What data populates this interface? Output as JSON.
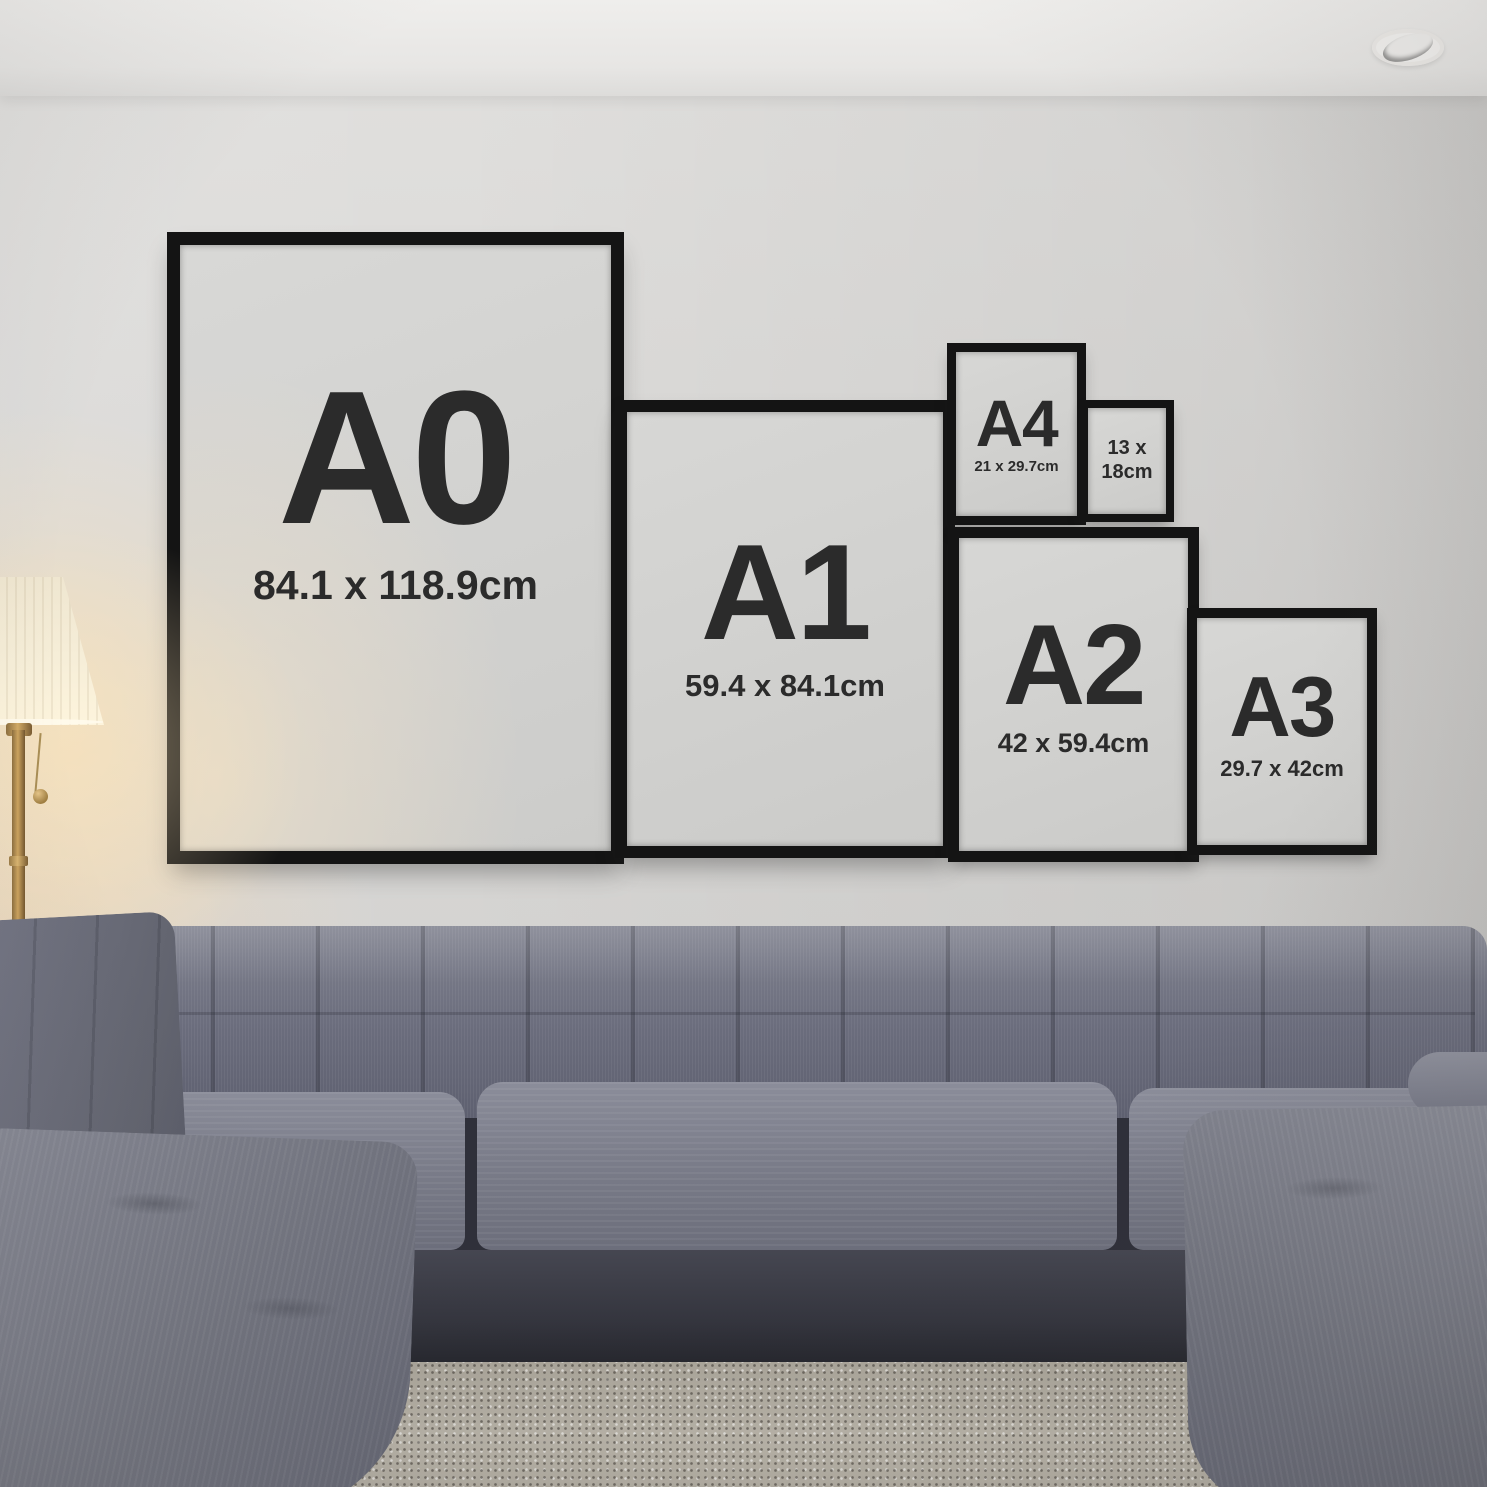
{
  "frames": [
    {
      "label": "A0",
      "size": "84.1 x 118.9cm"
    },
    {
      "label": "A1",
      "size": "59.4 x 84.1cm"
    },
    {
      "label": "A4",
      "size": "21 x 29.7cm"
    },
    {
      "size_line1": "13 x",
      "size_line2": "18cm"
    },
    {
      "label": "A2",
      "size": "42 x 59.4cm"
    },
    {
      "label": "A3",
      "size": "29.7 x 42cm"
    }
  ],
  "palette": {
    "frame_black": "#141414",
    "poster_paper": "#d2d2d0",
    "poster_text": "#2b2b2b",
    "wall": "#d8d7d5",
    "ceiling": "#ebeae8",
    "sofa_fabric": "#6f7180",
    "sofa_shadow": "#2f303a",
    "rug": "#b6b1a6",
    "lamp_shade": "#f6eed8",
    "lamp_brass": "#b2904f",
    "wood_floor": "#46332a"
  }
}
